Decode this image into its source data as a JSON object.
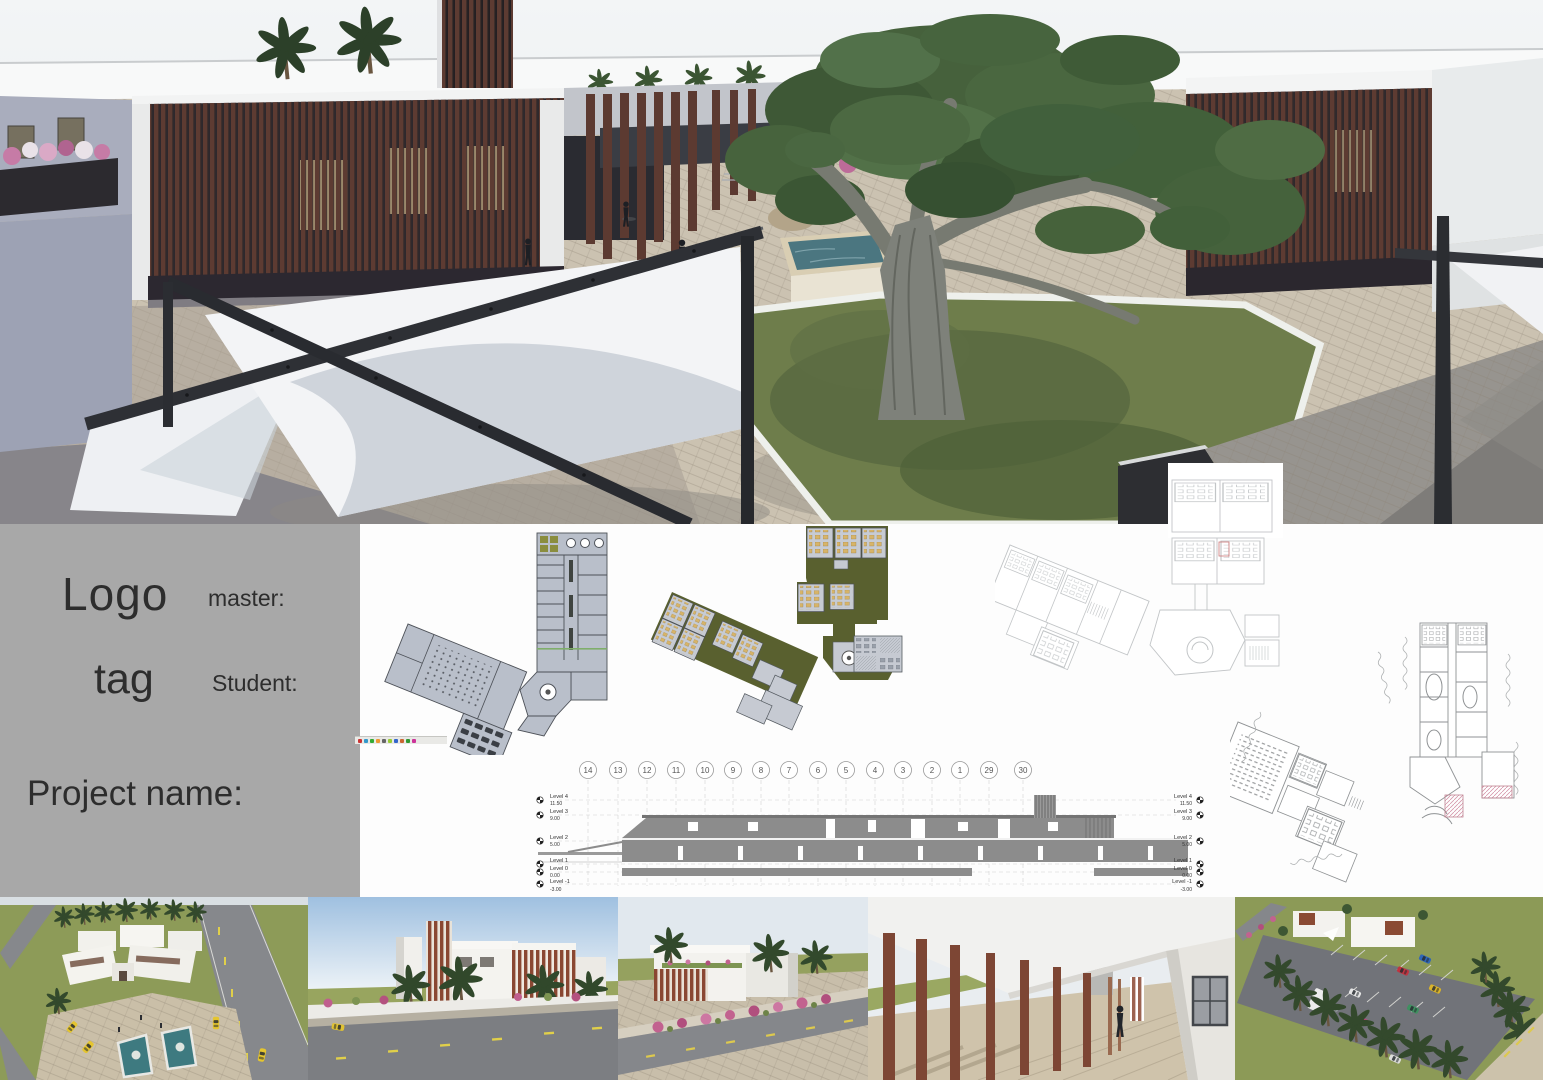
{
  "board": {
    "title_panel": {
      "logo_line_1": "Logo",
      "logo_line_2": "tag",
      "master_label": "master:",
      "student_label": "Student:",
      "project_name_label": "Project name:"
    }
  },
  "section_drawing": {
    "grid_bubbles": [
      "14",
      "13",
      "12",
      "11",
      "10",
      "9",
      "8",
      "7",
      "6",
      "5",
      "4",
      "3",
      "2",
      "1",
      "29",
      "30"
    ],
    "levels": [
      {
        "name": "Level 4",
        "elevation": "11.50"
      },
      {
        "name": "Level 3",
        "elevation": "9.00"
      },
      {
        "name": "Level 2",
        "elevation": "5.00"
      },
      {
        "name": "Level 1",
        "elevation": ""
      },
      {
        "name": "Level 0",
        "elevation": "0.00"
      },
      {
        "name": "Level -1",
        "elevation": "-3.00"
      }
    ]
  },
  "colors": {
    "panel_gray": "#a8a8a8",
    "text_dark": "#2d2d2d",
    "slat_brown": "#5d3b32",
    "lawn_green": "#6e7d4b",
    "olive_plan_roof": "#59602f",
    "plan_fill": "#b9bfca",
    "desk_tan": "#d7b469",
    "pool_teal": "#4b7680",
    "sail_white": "#f3f4f6",
    "steel_dark": "#2e3035",
    "section_gray": "#8c8c8c",
    "paving_beige": "#cbc2b1",
    "bougainvillea_pink": "#c2628f"
  }
}
